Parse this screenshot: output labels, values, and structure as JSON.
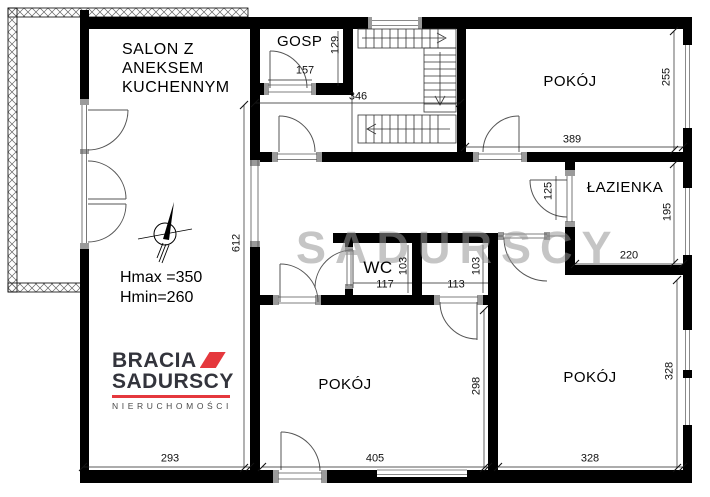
{
  "watermark": "SADURSCY",
  "rooms": {
    "salon": {
      "lines": [
        "SALON Z",
        "ANEKSEM",
        "KUCHENNYM"
      ]
    },
    "pom_gosp": {
      "lines": [
        "POM.",
        "GOSP"
      ]
    },
    "pokoj_top": "POKÓJ",
    "lazienka": "ŁAZIENKA",
    "wc": "WC",
    "pokoj_mid": "POKÓJ",
    "pokoj_right": "POKÓJ"
  },
  "dimensions": {
    "d129": "129",
    "d157": "157",
    "d346": "346",
    "d389": "389",
    "d255": "255",
    "d125": "125",
    "d195": "195",
    "d220": "220",
    "d103wc": "103",
    "d117": "117",
    "d113": "113",
    "d103cl": "103",
    "d612": "612",
    "d293": "293",
    "d405": "405",
    "d298": "298",
    "d328b": "328",
    "d328r": "328"
  },
  "notes": {
    "hmax": "Hmax =350",
    "hmin": "Hmin=260"
  },
  "logo": {
    "brand1": "BRACIA",
    "brand2": "SADURSCY",
    "tagline": "NIERUCHOMOŚCI"
  },
  "colors": {
    "wall": "#000000",
    "brand_red": "#e5383d",
    "dim_text": "#111111",
    "window_line": "#8a8a8a",
    "watermark": "#969696",
    "hatch": "#666666"
  }
}
